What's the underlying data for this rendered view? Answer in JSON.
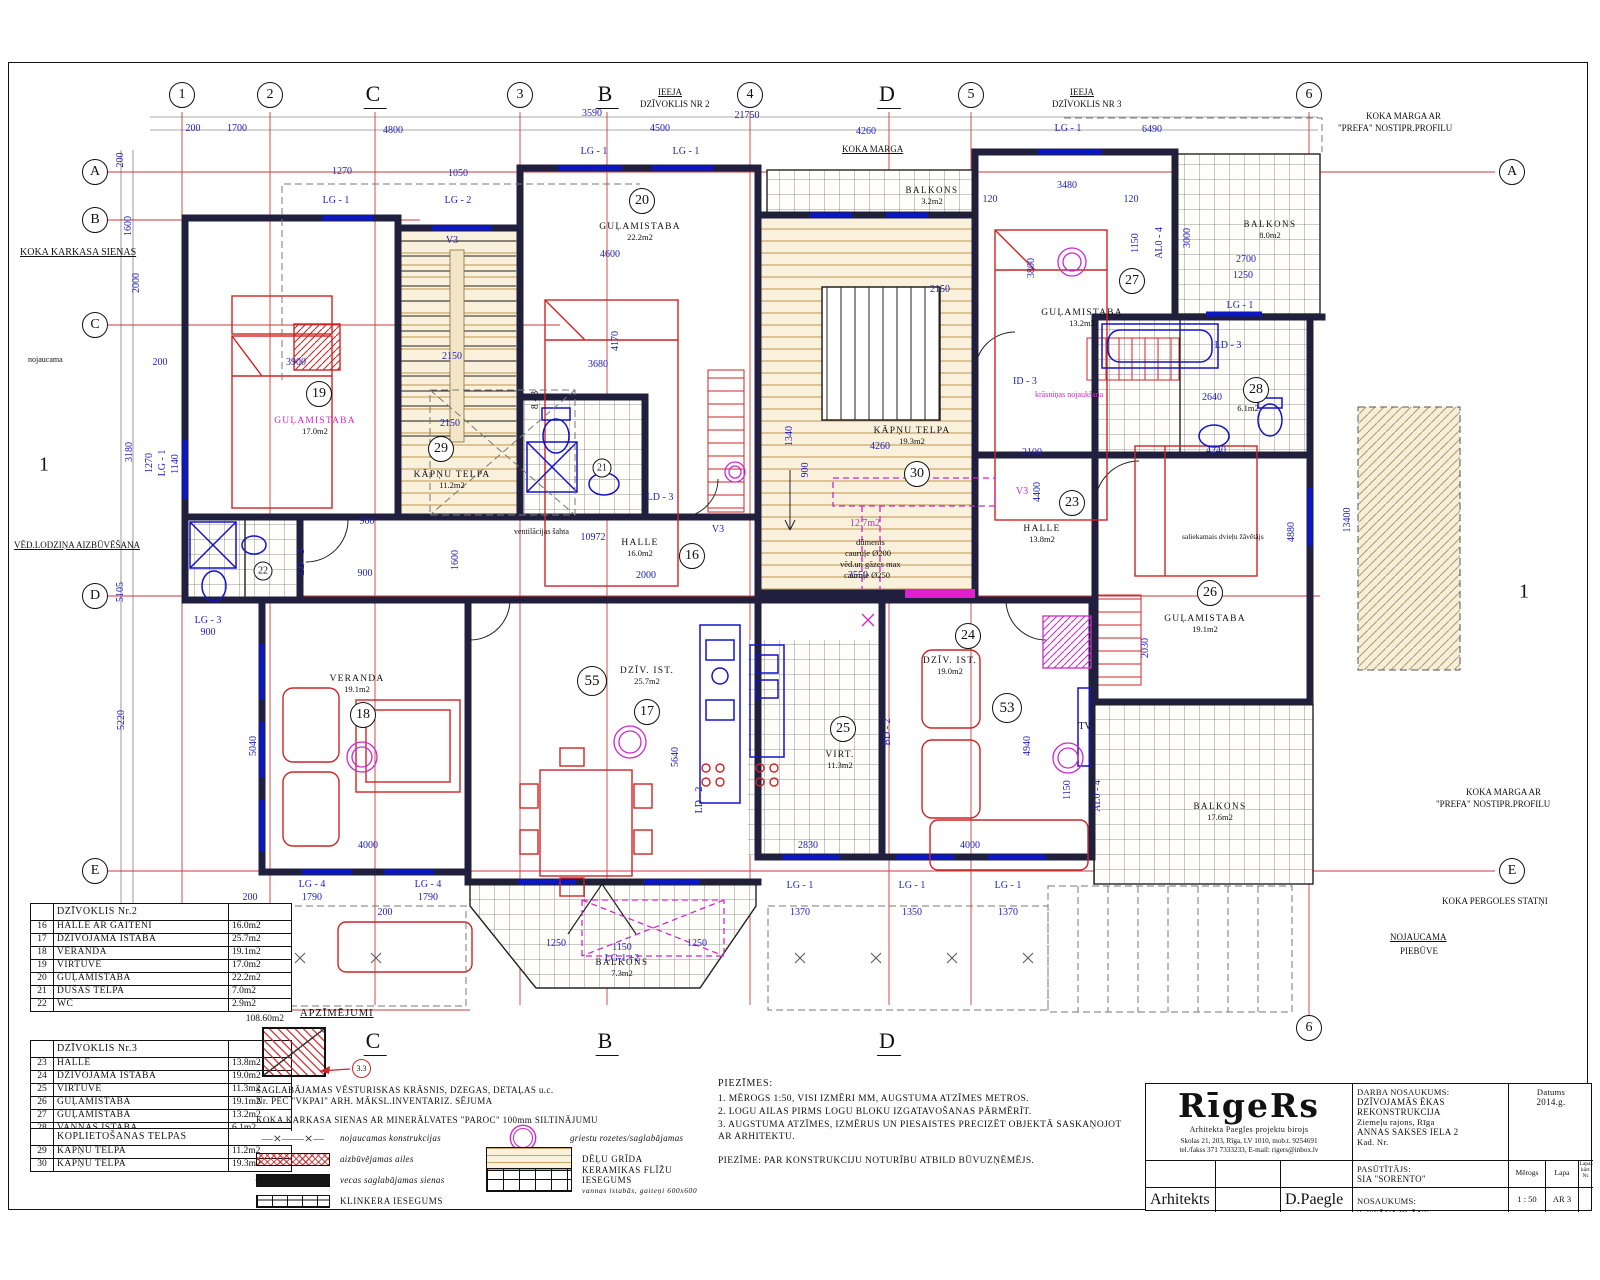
{
  "axes": {
    "top": [
      {
        "l": "1",
        "x": 182,
        "c": 1
      },
      {
        "l": "2",
        "x": 270,
        "c": 1
      },
      {
        "l": "C",
        "x": 375,
        "c": 0
      },
      {
        "l": "3",
        "x": 520,
        "c": 1
      },
      {
        "l": "B",
        "x": 607,
        "c": 0
      },
      {
        "l": "4",
        "x": 750,
        "c": 1
      },
      {
        "l": "D",
        "x": 889,
        "c": 0
      },
      {
        "l": "5",
        "x": 971,
        "c": 1
      },
      {
        "l": "6",
        "x": 1309,
        "c": 1
      }
    ],
    "left": [
      {
        "l": "A",
        "y": 172,
        "x2": 1495
      },
      {
        "l": "B",
        "y": 220,
        "x2": 420
      },
      {
        "l": "C",
        "y": 325,
        "x2": 560
      },
      {
        "l": "D",
        "y": 596,
        "x2": 1320
      },
      {
        "l": "E",
        "y": 871,
        "x2": 1495
      },
      {
        "l": "F",
        "y": 1010,
        "x2": 470
      }
    ],
    "right": [
      {
        "l": "A",
        "y": 172
      },
      {
        "l": "E",
        "y": 871
      }
    ],
    "bottom": [
      {
        "l": "C",
        "x": 375,
        "c": 0
      },
      {
        "l": "B",
        "x": 607,
        "c": 0
      },
      {
        "l": "D",
        "x": 889,
        "c": 0
      },
      {
        "l": "6",
        "x": 1309,
        "c": 1
      }
    ],
    "sections": [
      {
        "l": "1",
        "x": 44,
        "y": 465
      },
      {
        "l": "1",
        "x": 1524,
        "y": 592
      }
    ]
  },
  "rooms": [
    {
      "num": "16",
      "name": "HALLE",
      "area": "16.0m2",
      "nx": 640,
      "ny": 544,
      "cx": 692,
      "cy": 556
    },
    {
      "num": "17",
      "name": "DZĪV. IST.",
      "area": "25.7m2",
      "nx": 647,
      "ny": 672,
      "cx": 647,
      "cy": 712
    },
    {
      "num": "18",
      "name": "VERANDA",
      "area": "19.1m2",
      "nx": 357,
      "ny": 680,
      "cx": 363,
      "cy": 715
    },
    {
      "num": "19",
      "name": "GUĻAMISTABA",
      "area": "17.0m2",
      "nx": 315,
      "ny": 422,
      "cx": 319,
      "cy": 394,
      "mag": 1
    },
    {
      "num": "20",
      "name": "GUĻAMISTABA",
      "area": "22.2m2",
      "nx": 640,
      "ny": 228,
      "cx": 642,
      "cy": 201
    },
    {
      "num": "21",
      "cx": 602,
      "cy": 468,
      "small": 1
    },
    {
      "num": "22",
      "cx": 263,
      "cy": 571,
      "small": 1
    },
    {
      "num": "23",
      "name": "HALLE",
      "area": "13.8m2",
      "nx": 1042,
      "ny": 530,
      "cx": 1072,
      "cy": 503
    },
    {
      "num": "24",
      "name": "DZĪV. IST.",
      "area": "19.0m2",
      "nx": 950,
      "ny": 662,
      "cx": 968,
      "cy": 636
    },
    {
      "num": "25",
      "name": "VIRT.",
      "area": "11.3m2",
      "nx": 840,
      "ny": 756,
      "cx": 843,
      "cy": 729
    },
    {
      "num": "26",
      "name": "GUĻAMISTABA",
      "area": "19.1m2",
      "nx": 1205,
      "ny": 620,
      "cx": 1210,
      "cy": 593
    },
    {
      "num": "27",
      "name": "GUĻAMISTABA",
      "area": "13.2m2",
      "nx": 1082,
      "ny": 314,
      "cx": 1132,
      "cy": 281
    },
    {
      "num": "28",
      "name": "",
      "area": "6.1m2",
      "nx": 1248,
      "ny": 408,
      "cx": 1256,
      "cy": 390
    },
    {
      "num": "29",
      "name": "KĀPŅU TELPA",
      "area": "11.2m2",
      "nx": 452,
      "ny": 476,
      "cx": 441,
      "cy": 449
    },
    {
      "num": "30",
      "name": "KĀPŅU TELPA",
      "area": "19.3m2",
      "nx": 912,
      "ny": 432,
      "cx": 917,
      "cy": 474
    },
    {
      "num": "53",
      "cx": 1007,
      "cy": 708,
      "big": 1
    },
    {
      "num": "55",
      "cx": 592,
      "cy": 681,
      "big": 1
    }
  ],
  "balconies": [
    {
      "name": "BALKONS",
      "area": "3.2m2",
      "x": 932,
      "y": 190
    },
    {
      "name": "BALKONS",
      "area": "8.0m2",
      "x": 1270,
      "y": 224
    },
    {
      "name": "BALKONS",
      "area": "17.6m2",
      "x": 1220,
      "y": 806
    },
    {
      "name": "BALKONS",
      "area": "7.3m2",
      "x": 622,
      "y": 962
    }
  ],
  "dims": [
    {
      "t": "200",
      "x": 193,
      "y": 129
    },
    {
      "t": "1700",
      "x": 237,
      "y": 129
    },
    {
      "t": "4800",
      "x": 393,
      "y": 131
    },
    {
      "t": "3590",
      "x": 592,
      "y": 114
    },
    {
      "t": "4500",
      "x": 660,
      "y": 129
    },
    {
      "t": "21750",
      "x": 747,
      "y": 116
    },
    {
      "t": "4260",
      "x": 866,
      "y": 132
    },
    {
      "t": "6490",
      "x": 1152,
      "y": 130
    },
    {
      "t": "1270",
      "x": 342,
      "y": 172
    },
    {
      "t": "1050",
      "x": 458,
      "y": 174
    },
    {
      "t": "LG - 1",
      "x": 336,
      "y": 201
    },
    {
      "t": "LG - 2",
      "x": 458,
      "y": 201
    },
    {
      "t": "LG - 1",
      "x": 594,
      "y": 152
    },
    {
      "t": "LG - 1",
      "x": 686,
      "y": 152
    },
    {
      "t": "LG - 1",
      "x": 1068,
      "y": 129
    },
    {
      "t": "3480",
      "x": 1067,
      "y": 186
    },
    {
      "t": "120",
      "x": 990,
      "y": 200
    },
    {
      "t": "120",
      "x": 1131,
      "y": 200
    },
    {
      "t": "3800",
      "x": 1032,
      "y": 268,
      "r": 1
    },
    {
      "t": "1150",
      "x": 1136,
      "y": 243,
      "r": 1
    },
    {
      "t": "AL0 - 4",
      "x": 1160,
      "y": 243,
      "r": 1
    },
    {
      "t": "3000",
      "x": 1188,
      "y": 238,
      "r": 1
    },
    {
      "t": "2700",
      "x": 1246,
      "y": 260
    },
    {
      "t": "1250",
      "x": 1243,
      "y": 276
    },
    {
      "t": "LG - 1",
      "x": 1240,
      "y": 306
    },
    {
      "t": "4600",
      "x": 610,
      "y": 255
    },
    {
      "t": "4170",
      "x": 616,
      "y": 341,
      "r": 1
    },
    {
      "t": "3680",
      "x": 598,
      "y": 365
    },
    {
      "t": "2150",
      "x": 452,
      "y": 357
    },
    {
      "t": "2150",
      "x": 450,
      "y": 424
    },
    {
      "t": "2150",
      "x": 940,
      "y": 290
    },
    {
      "t": "3900",
      "x": 296,
      "y": 363
    },
    {
      "t": "200",
      "x": 160,
      "y": 363
    },
    {
      "t": "200",
      "x": 121,
      "y": 160,
      "r": 1
    },
    {
      "t": "1600",
      "x": 129,
      "y": 226,
      "r": 1
    },
    {
      "t": "2000",
      "x": 137,
      "y": 283,
      "r": 1
    },
    {
      "t": "3180",
      "x": 130,
      "y": 452,
      "r": 1
    },
    {
      "t": "1270",
      "x": 150,
      "y": 463,
      "r": 1
    },
    {
      "t": "LG - 1",
      "x": 163,
      "y": 463,
      "r": 1
    },
    {
      "t": "1140",
      "x": 176,
      "y": 464,
      "r": 1
    },
    {
      "t": "5105",
      "x": 121,
      "y": 592,
      "r": 1
    },
    {
      "t": "5220",
      "x": 122,
      "y": 720,
      "r": 1
    },
    {
      "t": "LG - 3",
      "x": 208,
      "y": 621
    },
    {
      "t": "900",
      "x": 208,
      "y": 633
    },
    {
      "t": "10972",
      "x": 593,
      "y": 538
    },
    {
      "t": "900",
      "x": 367,
      "y": 522
    },
    {
      "t": "900",
      "x": 365,
      "y": 574
    },
    {
      "t": "1600",
      "x": 456,
      "y": 560,
      "r": 1
    },
    {
      "t": "2000",
      "x": 646,
      "y": 576
    },
    {
      "t": "3550",
      "x": 858,
      "y": 576
    },
    {
      "t": "4260",
      "x": 880,
      "y": 447
    },
    {
      "t": "1340",
      "x": 790,
      "y": 436,
      "r": 1
    },
    {
      "t": "900",
      "x": 806,
      "y": 470,
      "r": 1
    },
    {
      "t": "2100",
      "x": 1032,
      "y": 453
    },
    {
      "t": "4400",
      "x": 1038,
      "y": 492,
      "r": 1
    },
    {
      "t": "4240",
      "x": 1216,
      "y": 451
    },
    {
      "t": "4880",
      "x": 1292,
      "y": 532,
      "r": 1
    },
    {
      "t": "13400",
      "x": 1348,
      "y": 520,
      "r": 1
    },
    {
      "t": "2030",
      "x": 1146,
      "y": 648,
      "r": 1
    },
    {
      "t": "5640",
      "x": 676,
      "y": 757,
      "r": 1
    },
    {
      "t": "5040",
      "x": 254,
      "y": 746,
      "r": 1
    },
    {
      "t": "4000",
      "x": 368,
      "y": 846
    },
    {
      "t": "2830",
      "x": 808,
      "y": 846
    },
    {
      "t": "4000",
      "x": 970,
      "y": 846
    },
    {
      "t": "4940",
      "x": 1028,
      "y": 746,
      "r": 1
    },
    {
      "t": "1150",
      "x": 1068,
      "y": 790,
      "r": 1
    },
    {
      "t": "AL0 - 4",
      "x": 1098,
      "y": 796,
      "r": 1
    },
    {
      "t": "BD - 2",
      "x": 888,
      "y": 732,
      "r": 1
    },
    {
      "t": "LD - 2",
      "x": 700,
      "y": 800,
      "r": 1
    },
    {
      "t": "LG - 4",
      "x": 312,
      "y": 885
    },
    {
      "t": "1790",
      "x": 312,
      "y": 898
    },
    {
      "t": "LG - 4",
      "x": 428,
      "y": 885
    },
    {
      "t": "1790",
      "x": 428,
      "y": 898
    },
    {
      "t": "200",
      "x": 250,
      "y": 898
    },
    {
      "t": "200",
      "x": 385,
      "y": 913
    },
    {
      "t": "1150",
      "x": 622,
      "y": 948
    },
    {
      "t": "LG-1 +2",
      "x": 622,
      "y": 959
    },
    {
      "t": "1250",
      "x": 556,
      "y": 944
    },
    {
      "t": "1250",
      "x": 697,
      "y": 944
    },
    {
      "t": "LG - 1",
      "x": 800,
      "y": 886
    },
    {
      "t": "1370",
      "x": 800,
      "y": 913
    },
    {
      "t": "LG - 1",
      "x": 912,
      "y": 886
    },
    {
      "t": "1350",
      "x": 912,
      "y": 913
    },
    {
      "t": "LG - 1",
      "x": 1008,
      "y": 886
    },
    {
      "t": "1370",
      "x": 1008,
      "y": 913
    },
    {
      "t": "2640",
      "x": 1212,
      "y": 398
    },
    {
      "t": "ID - 3",
      "x": 1025,
      "y": 382
    },
    {
      "t": "V3",
      "x": 452,
      "y": 241
    },
    {
      "t": "V3",
      "x": 718,
      "y": 530
    },
    {
      "t": "V3",
      "x": 1022,
      "y": 492,
      "c": "m"
    },
    {
      "t": "LD - 3",
      "x": 302,
      "y": 562,
      "r": 1
    },
    {
      "t": "LD - 3",
      "x": 660,
      "y": 498
    },
    {
      "t": "LD - 3",
      "x": 1228,
      "y": 346
    },
    {
      "t": "12.7m2",
      "x": 865,
      "y": 524,
      "c": "m"
    },
    {
      "t": "8 - 3",
      "x": 536,
      "y": 400,
      "r": 1,
      "c": "k"
    },
    {
      "t": "TV",
      "x": 1085,
      "y": 727,
      "c": "k"
    }
  ],
  "annotations": [
    {
      "t": "KOKA KARKASA SIENAS",
      "x": 20,
      "y": 247,
      "s": 10,
      "u": 1
    },
    {
      "t": "nojaucama",
      "x": 28,
      "y": 356,
      "s": 8
    },
    {
      "t": "VĒD.LODZIŅA AIZBŪVĒŠANA",
      "x": 14,
      "y": 541,
      "s": 9,
      "u": 1
    },
    {
      "t": "IEEJA",
      "x": 658,
      "y": 88,
      "s": 9,
      "u": 1
    },
    {
      "t": "DZĪVOKLIS NR 2",
      "x": 640,
      "y": 100,
      "s": 9
    },
    {
      "t": "IEEJA",
      "x": 1070,
      "y": 88,
      "s": 9,
      "u": 1
    },
    {
      "t": "DZĪVOKLIS NR 3",
      "x": 1052,
      "y": 100,
      "s": 9
    },
    {
      "t": "KOKA MARGA",
      "x": 842,
      "y": 145,
      "s": 9,
      "u": 1
    },
    {
      "t": "KOKA MARGA AR",
      "x": 1366,
      "y": 112,
      "s": 9
    },
    {
      "t": "\"PREFA\" NOSTIPR.PROFILU",
      "x": 1338,
      "y": 124,
      "s": 9
    },
    {
      "t": "KOKA MARGA AR",
      "x": 1466,
      "y": 788,
      "s": 9
    },
    {
      "t": "\"PREFA\" NOSTIPR.PROFILU",
      "x": 1436,
      "y": 800,
      "s": 9
    },
    {
      "t": "KOKA PERGOLES STATŅI",
      "x": 1442,
      "y": 897,
      "s": 9
    },
    {
      "t": "NOJAUCAMA",
      "x": 1390,
      "y": 933,
      "s": 9,
      "u": 1
    },
    {
      "t": "PIEBŪVE",
      "x": 1400,
      "y": 947,
      "s": 9
    },
    {
      "t": "ventilācijas šahta",
      "x": 514,
      "y": 528,
      "s": 8
    },
    {
      "t": "dūmenis",
      "x": 856,
      "y": 538,
      "s": 8.5
    },
    {
      "t": "cauruļe Ø200",
      "x": 845,
      "y": 549,
      "s": 8.5
    },
    {
      "t": "vēd.un gāzes max",
      "x": 840,
      "y": 560,
      "s": 8.5
    },
    {
      "t": "cauruļe Ø250",
      "x": 844,
      "y": 571,
      "s": 8.5
    },
    {
      "t": "saliekamais dvieļu žāvētājs",
      "x": 1182,
      "y": 533,
      "s": 7.5
    },
    {
      "t": "krāsniņas nojaukšana",
      "x": 1035,
      "y": 391,
      "s": 8,
      "c": "m"
    }
  ],
  "tables": [
    {
      "x": 30,
      "y": 903,
      "title": "DZĪVOKLIS Nr.2",
      "total": "108.60m2",
      "rows": [
        [
          "16",
          "HALLE AR GAITENI",
          "16.0m2"
        ],
        [
          "17",
          "DZĪVOJAMĀ ISTABA",
          "25.7m2"
        ],
        [
          "18",
          "VERANDA",
          "19.1m2"
        ],
        [
          "19",
          "VIRTUVE",
          "17.0m2"
        ],
        [
          "20",
          "GUĻAMISTABA",
          "22.2m2"
        ],
        [
          "21",
          "DUŠAS TELPA",
          "7.0m2"
        ],
        [
          "22",
          "WC",
          "2.9m2"
        ]
      ]
    },
    {
      "x": 30,
      "y": 1040,
      "title": "DZĪVOKLIS Nr.3",
      "total": "82.5m2",
      "rows": [
        [
          "23",
          "HALLE",
          "13.8m2"
        ],
        [
          "24",
          "DZĪVOJAMĀ ISTABA",
          "19.0m2"
        ],
        [
          "25",
          "VIRTUVE",
          "11.3m2"
        ],
        [
          "26",
          "GUĻAMISTABA",
          "19.1m2"
        ],
        [
          "27",
          "GUĻAMISTABA",
          "13.2m2"
        ],
        [
          "28",
          "VANNAS ISTABA",
          "6.1m2"
        ]
      ]
    },
    {
      "x": 30,
      "y": 1128,
      "title": "KOPLIETOŠANAS TELPAS",
      "total": "30.5m2",
      "rows": [
        [
          "29",
          "KĀPŅU TELPA",
          "11.2m2"
        ],
        [
          "30",
          "KĀPŅU TELPA",
          "19.3m2"
        ]
      ]
    }
  ],
  "legend": {
    "title": "APZĪMĒJUMI",
    "marker": "3.3",
    "note1": "SAGLABĀJAMAS VĒSTURISKAS KRĀSNIS, DZEGAS, DETAĻAS u.c.",
    "note1b": "Nr. PĒC \"VKPAI\" ARH. MĀKSL.INVENTARIZ. SĒJUMA",
    "note2": "KOKA KARKASA SIENAS AR MINERĀLVATES \"PAROC\" 100mm SILTINĀJUMU",
    "left": [
      {
        "sw": "xline",
        "label": "nojaucamas konstrukcijas",
        "glyph": "—⨯——⨯—"
      },
      {
        "sw": "redcross",
        "label": "aizbūvējamas ailes"
      },
      {
        "sw": "black",
        "label": "vecas saglabājamas sienas"
      },
      {
        "sw": "grid",
        "label": "KLINKERA IESEGUMS",
        "up": 1
      }
    ],
    "right": [
      {
        "sw": "rosette",
        "label": "griestu rozetes/saglabājamas"
      },
      {
        "sw": "wood",
        "label": "DĒĻU GRĪDA",
        "up": 1
      },
      {
        "sw": "tile",
        "label": "KERAMIKAS FLĪŽU IESEGUMS",
        "up": 1,
        "label2": "vannas istabās, gaiteņi 600x600"
      }
    ]
  },
  "notes": {
    "title": "PIEZĪMES:",
    "items": [
      "1. MĒROGS 1:50, VISI IZMĒRI MM, AUGSTUMA ATZĪMES METROS.",
      "2. LOGU AILAS PIRMS LOGU BLOKU IZGATAVOŠANAS PĀRMĒRĪT.",
      "3. AUGSTUMA ATZĪMES, IZMĒRUS UN PIESAISTES PRECIZĒT OBJEKTĀ SASKAŅOJOT",
      "    AR ARHITEKTU."
    ],
    "footer": "PIEZĪME: PAR KONSTRUKCIJU NOTURĪBU ATBILD BŪVUZŅĒMĒJS."
  },
  "titleblock": {
    "logo": "RīgeRs",
    "sub": "Arhitekta Paegles projektu birojs",
    "addr1": "Skolas 21, 203, Rīga, LV 1010, mob.t. 9254691",
    "addr2": "tel./fakss 371 7333233, E-mail: rigers@inbox.lv",
    "job_label": "DARBA NOSAUKUMS:",
    "job1": "DZĪVOJAMĀS ĒKAS",
    "job2": "REKONSTRUKCIJA",
    "job3": "Ziemeļu rajons, Rīga",
    "job4": "ANNAS SAKSES IELA 2",
    "job5": "Kad. Nr.",
    "date_label": "Datums",
    "date": "2014.g.",
    "client_label": "PASŪTĪTĀJS:",
    "client": "SIA \"SORENTO\"",
    "scale_label": "Mērogs",
    "sheet_label": "Lapa",
    "sheetno_label": "Lapas kārt. Nr.",
    "name_label": "NOSAUKUMS:",
    "name": "2. STĀVA PLĀNS",
    "scale": "1 : 50",
    "sheet": "AR 3",
    "role": "Arhitekts",
    "author": "D.Paegle"
  }
}
